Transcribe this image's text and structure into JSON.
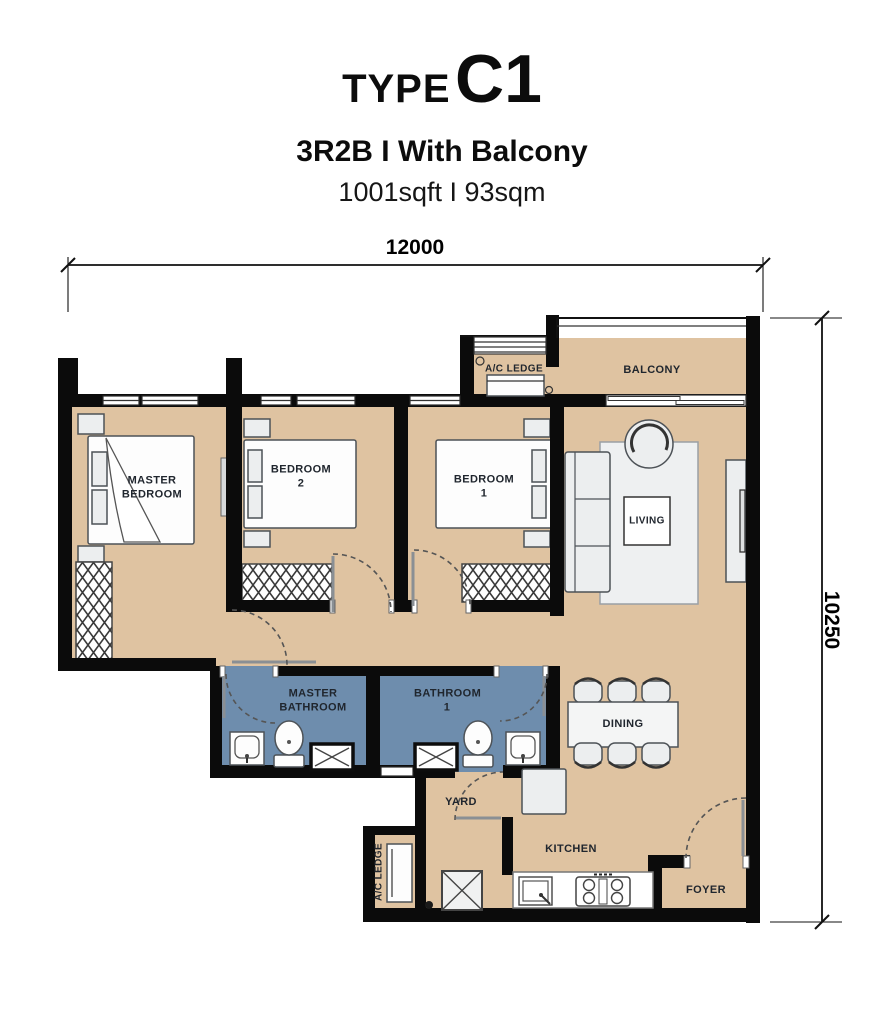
{
  "header": {
    "type_prefix": "TYPE",
    "type_code": "C1",
    "config_line": "3R2B I With Balcony",
    "area_line": "1001sqft I 93sqm"
  },
  "dimensions": {
    "width_label": "12000",
    "height_label": "10250"
  },
  "rooms": {
    "master_bedroom": "MASTER BEDROOM",
    "bedroom_2": "BEDROOM 2",
    "bedroom_1": "BEDROOM 1",
    "living": "LIVING",
    "balcony": "BALCONY",
    "ac_ledge_top": "A/C LEDGE",
    "master_bathroom": "MASTER BATHROOM",
    "bathroom_1": "BATHROOM 1",
    "dining": "DINING",
    "yard": "YARD",
    "kitchen": "KITCHEN",
    "foyer": "FOYER",
    "ac_ledge_bottom": "A/C LEDGE"
  },
  "colors": {
    "floor": "#dfc3a1",
    "bathroom_floor": "#6e8dad",
    "wall": "#0b0b0b",
    "furniture": "#eceeef"
  }
}
